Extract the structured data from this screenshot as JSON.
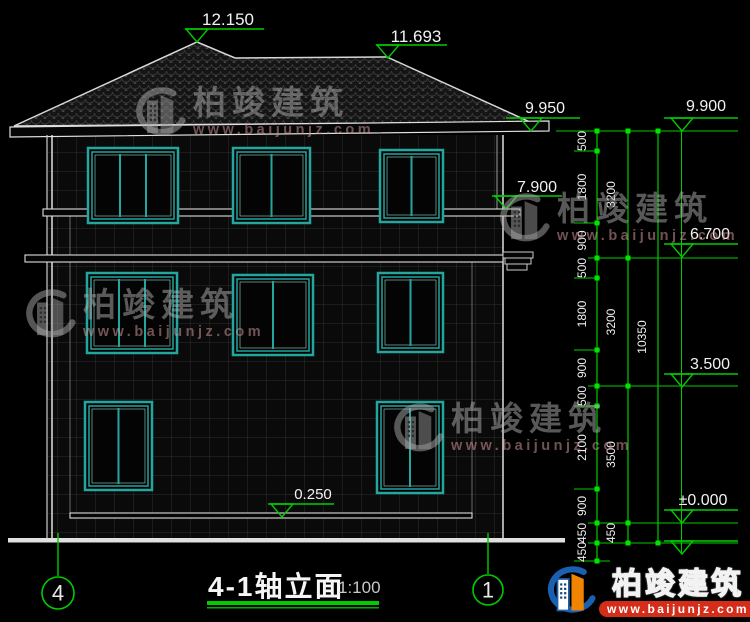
{
  "meta": {
    "drawing_title": "4-1轴立面",
    "drawing_scale": "1:100"
  },
  "watermark": {
    "brand": "柏竣建筑",
    "url": "www.baijunjz.com",
    "positions": [
      {
        "x": 128,
        "y": 86
      },
      {
        "x": 492,
        "y": 192
      },
      {
        "x": 18,
        "y": 288
      },
      {
        "x": 386,
        "y": 402
      }
    ]
  },
  "footer_logo": {
    "brand": "柏竣建筑",
    "url": "www.baijunjz.com"
  },
  "axis_bubbles": [
    {
      "label": "4",
      "cx": 58,
      "cy": 593,
      "r": 16,
      "lx": 58,
      "ly1": 533,
      "ly2": 576
    },
    {
      "label": "1",
      "cx": 488,
      "cy": 590,
      "r": 15,
      "lx": 488,
      "ly1": 533,
      "ly2": 574
    }
  ],
  "elevation_markers": [
    {
      "label": "12.150",
      "tx": 228,
      "ty": 25,
      "lx1": 185,
      "lx2": 264,
      "ax": 197,
      "ay": 42,
      "fs": 17
    },
    {
      "label": "11.693",
      "tx": 416,
      "ty": 42,
      "lx1": 376,
      "lx2": 447,
      "ax": 388,
      "ay": 58,
      "fs": 17
    },
    {
      "label": "9.950",
      "tx": 545,
      "ty": 113,
      "lx1": 506,
      "lx2": 580,
      "ax": 531,
      "ay": 131,
      "fs": 16
    },
    {
      "label": "9.900",
      "tx": 706,
      "ty": 111,
      "lx1": 664,
      "lx2": 738,
      "ax": 682,
      "ay": 131,
      "fs": 16
    },
    {
      "label": "7.900",
      "tx": 537,
      "ty": 192,
      "lx1": 492,
      "lx2": 562,
      "ax": 506,
      "ay": 209,
      "fs": 16
    },
    {
      "label": "6.700",
      "tx": 710,
      "ty": 239,
      "lx1": 664,
      "lx2": 738,
      "ax": 682,
      "ay": 257,
      "fs": 16
    },
    {
      "label": "3.500",
      "tx": 710,
      "ty": 369,
      "lx1": 664,
      "lx2": 738,
      "ax": 682,
      "ay": 387,
      "fs": 16
    },
    {
      "label": "±0.000",
      "tx": 703,
      "ty": 505,
      "lx1": 664,
      "lx2": 738,
      "ax": 682,
      "ay": 523,
      "fs": 16
    },
    {
      "label": "",
      "tx": 0,
      "ty": 0,
      "lx1": 664,
      "lx2": 738,
      "ax": 682,
      "ay": 554,
      "fs": 16
    },
    {
      "label": "0.250",
      "tx": 313,
      "ty": 499,
      "lx1": 268,
      "lx2": 334,
      "ax": 282,
      "ay": 517,
      "fs": 15
    }
  ],
  "dimension_chains": [
    {
      "x": 597,
      "textX": 586,
      "y1": 131,
      "y2": 561,
      "ticks": [
        131,
        151,
        223,
        258,
        278,
        350,
        386,
        406,
        489,
        523,
        543,
        561
      ],
      "labels": [
        "500",
        "1800",
        "900",
        "500",
        "1800",
        "900",
        "500",
        "2100",
        "900",
        "450",
        "450"
      ]
    },
    {
      "x": 628,
      "textX": 615,
      "y1": 131,
      "y2": 543,
      "ticks": [
        131,
        258,
        386,
        523,
        543
      ],
      "labels": [
        "3200",
        "3200",
        "3500",
        "450"
      ]
    },
    {
      "x": 658,
      "textX": 646,
      "y1": 131,
      "y2": 543,
      "ticks": [
        131,
        543
      ],
      "labels": [
        "10350"
      ]
    }
  ],
  "connector_lines": [
    {
      "y": 131,
      "x1": 556,
      "x2": 738
    },
    {
      "y": 258,
      "x1": 588,
      "x2": 738
    },
    {
      "y": 386,
      "x1": 588,
      "x2": 738
    },
    {
      "y": 523,
      "x1": 588,
      "x2": 738
    },
    {
      "y": 543,
      "x1": 588,
      "x2": 738
    },
    {
      "y": 151,
      "x1": 574,
      "x2": 600
    },
    {
      "y": 223,
      "x1": 574,
      "x2": 600
    },
    {
      "y": 278,
      "x1": 574,
      "x2": 600
    },
    {
      "y": 350,
      "x1": 574,
      "x2": 600
    },
    {
      "y": 406,
      "x1": 574,
      "x2": 600
    },
    {
      "y": 489,
      "x1": 574,
      "x2": 600
    },
    {
      "y": 561,
      "x1": 574,
      "x2": 610
    }
  ],
  "right_leader": {
    "x": 681.5,
    "y1": 131,
    "y2": 554
  },
  "windows": [
    {
      "x": 88,
      "y": 148,
      "w": 90,
      "h": 75,
      "panes": 3
    },
    {
      "x": 233,
      "y": 148,
      "w": 77,
      "h": 75,
      "panes": 2
    },
    {
      "x": 380,
      "y": 150,
      "w": 63,
      "h": 72,
      "panes": 2
    },
    {
      "x": 87,
      "y": 273,
      "w": 90,
      "h": 80,
      "panes": 3
    },
    {
      "x": 233,
      "y": 275,
      "w": 80,
      "h": 80,
      "panes": 2
    },
    {
      "x": 378,
      "y": 273,
      "w": 65,
      "h": 79,
      "panes": 2
    },
    {
      "x": 85,
      "y": 402,
      "w": 67,
      "h": 88,
      "panes": 2
    },
    {
      "x": 377,
      "y": 402,
      "w": 66,
      "h": 91,
      "panes": 2
    }
  ],
  "colors": {
    "green": "#00cc00",
    "tick_green": "#00e400",
    "teal": "#23a69e",
    "line_white": "#e2e2e2",
    "logo_blue": "#1b5fb0",
    "logo_orange": "#f08300",
    "logo_red": "#d62c1a"
  }
}
